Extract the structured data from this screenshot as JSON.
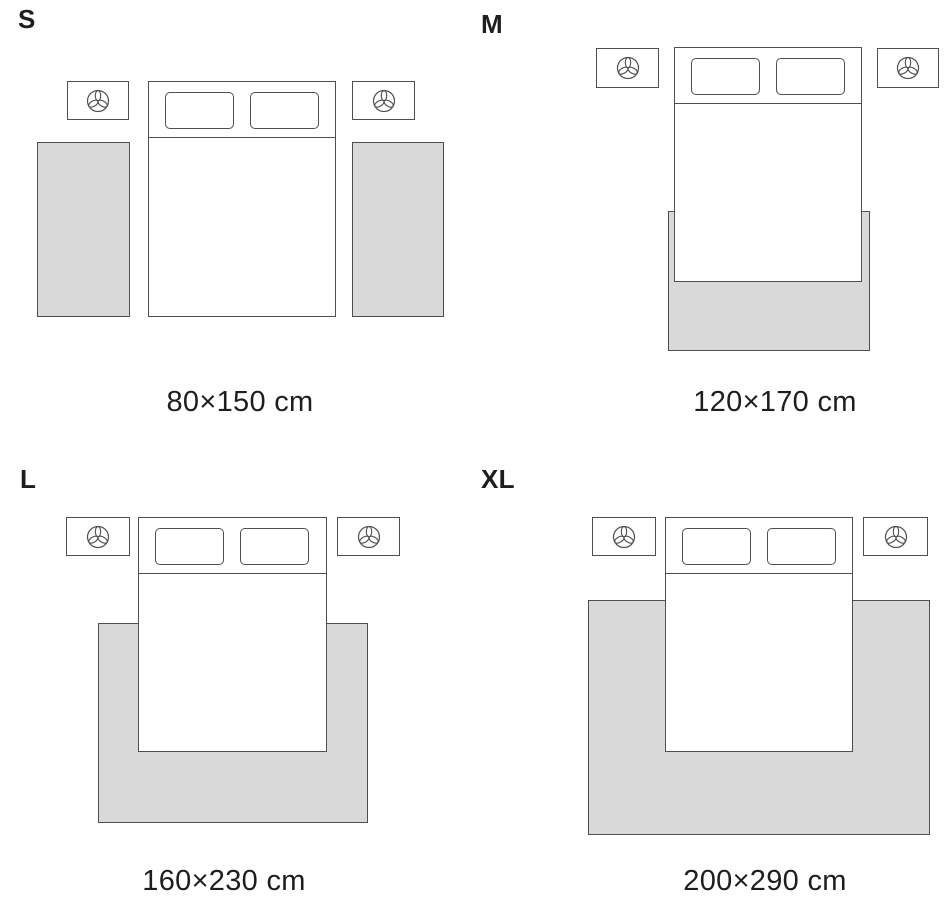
{
  "colors": {
    "background": "#ffffff",
    "rug": "#d9d9d9",
    "outline": "#4f4f4f",
    "text": "#1e1e1e"
  },
  "icons": {
    "nightstand": "plant-icon"
  },
  "panels": [
    {
      "size_label": "S",
      "dimensions": "80×150 cm"
    },
    {
      "size_label": "M",
      "dimensions": "120×170 cm"
    },
    {
      "size_label": "L",
      "dimensions": "160×230 cm"
    },
    {
      "size_label": "XL",
      "dimensions": "200×290 cm"
    }
  ]
}
